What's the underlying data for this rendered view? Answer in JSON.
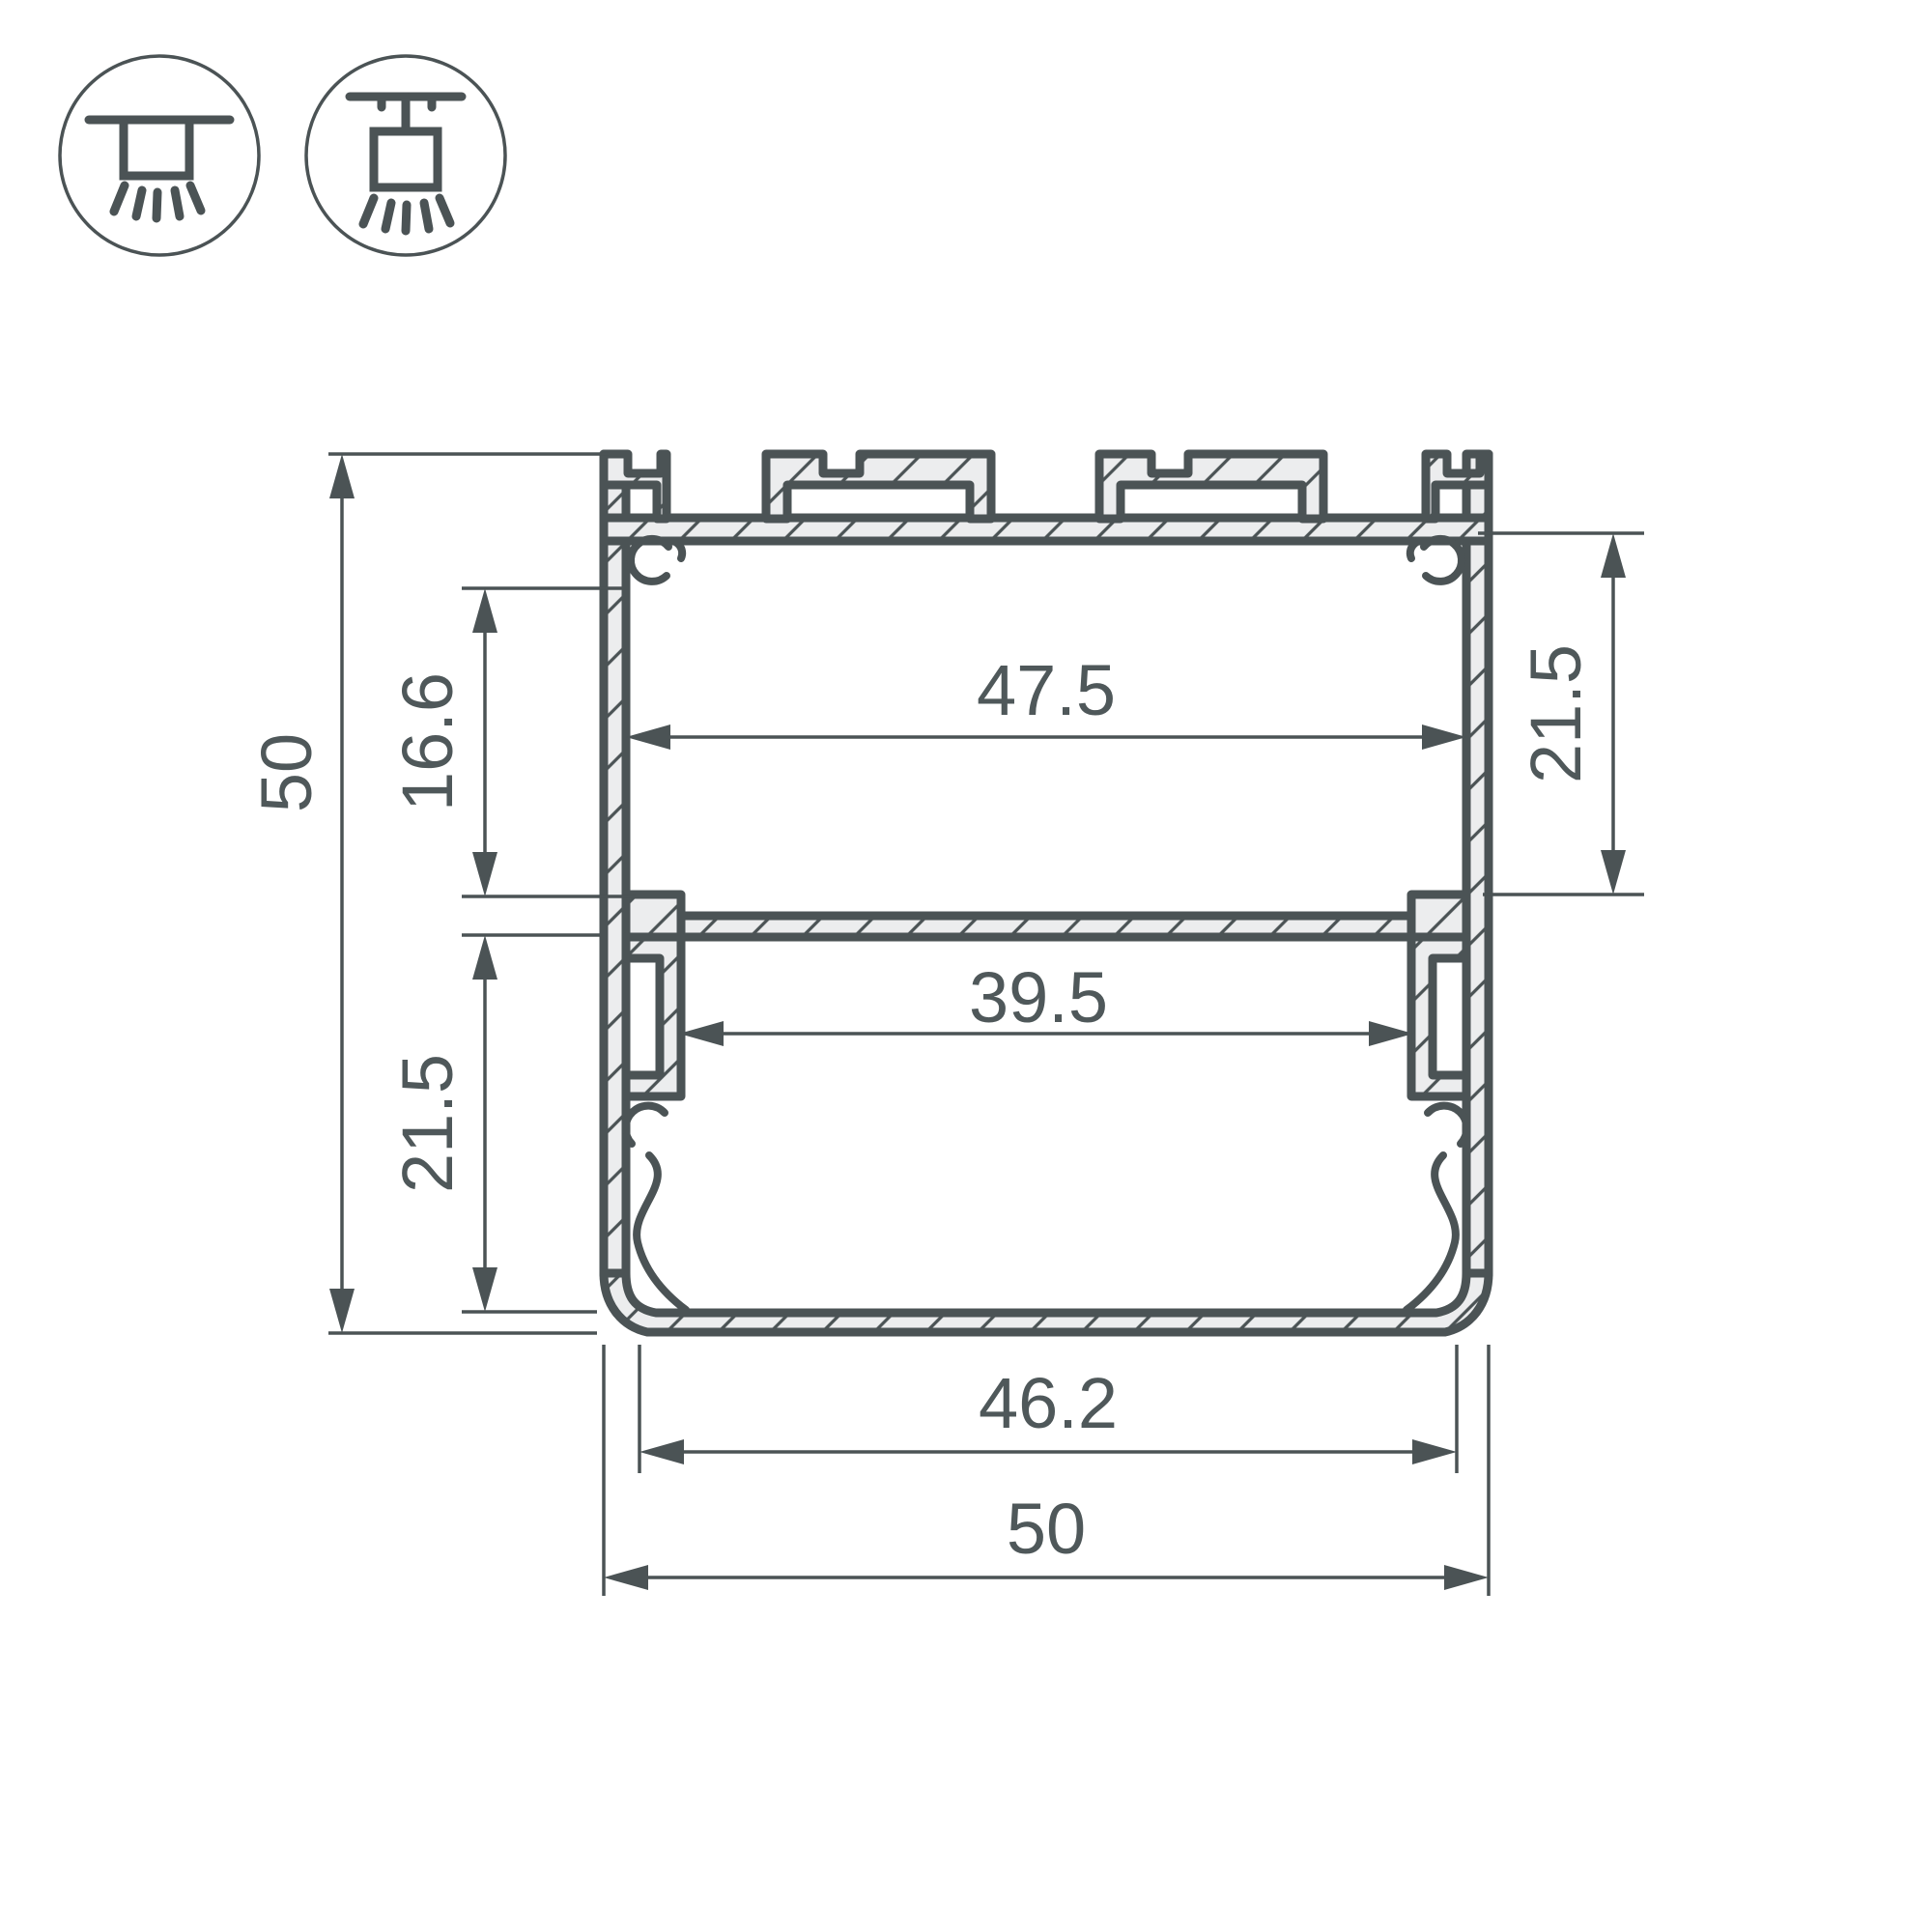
{
  "meta": {
    "drawing_type": "aluminium LED profile cross-section, dimensioned technical drawing",
    "background_color": "#ffffff",
    "line_color": "#4b5355",
    "material_fill_color": "#ecedee",
    "text_color": "#4f585a"
  },
  "mounting_icons": {
    "surface": {
      "name": "surface-ceiling-mount-icon"
    },
    "pendant": {
      "name": "suspended-pendant-mount-icon"
    }
  },
  "dimensions": {
    "overall_height": "50",
    "upper_side_inset": "16.6",
    "lower_chamber_height": "21.5",
    "upper_chamber_width": "47.5",
    "upper_chamber_height_right": "21.5",
    "lower_chamber_width": "39.5",
    "bottom_opening_width": "46.2",
    "overall_width": "50"
  }
}
